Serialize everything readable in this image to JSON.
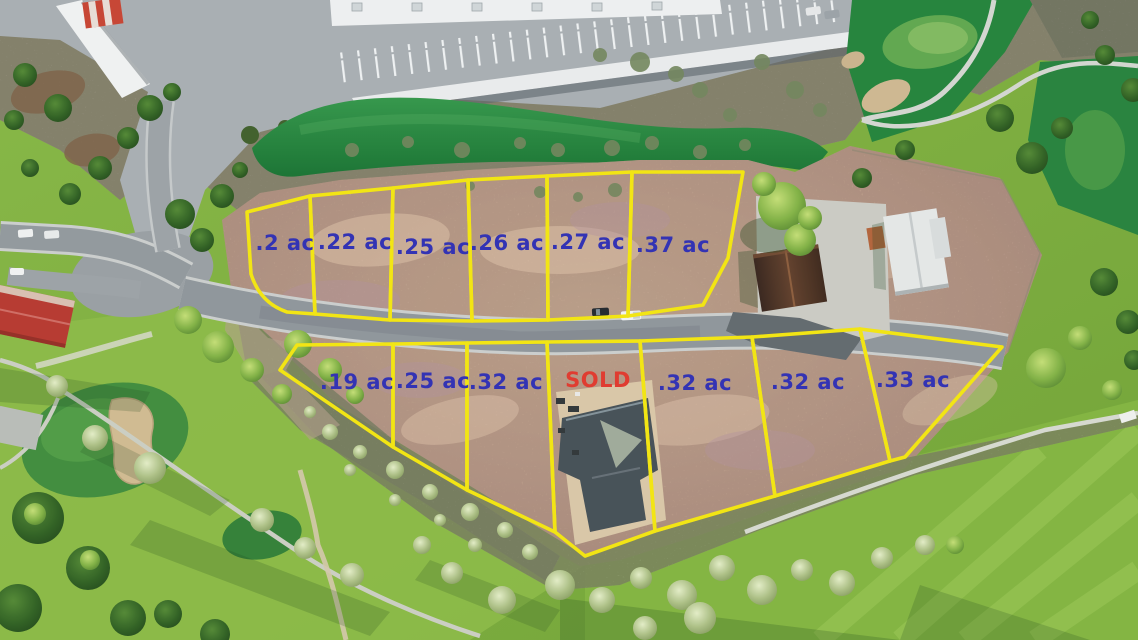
{
  "colors": {
    "lot_line_yellow": "#F2E40C",
    "label_blue": "#2B2BB2",
    "sold_red": "#DF352A"
  },
  "lots": {
    "top_row": [
      {
        "id": "top-1",
        "label": ".2 ac"
      },
      {
        "id": "top-2",
        "label": ".22 ac"
      },
      {
        "id": "top-3",
        "label": ".25 ac"
      },
      {
        "id": "top-4",
        "label": ".26 ac"
      },
      {
        "id": "top-5",
        "label": ".27 ac"
      },
      {
        "id": "top-6",
        "label": ".37 ac"
      }
    ],
    "bottom_row": [
      {
        "id": "bottom-1",
        "label": ".19 ac"
      },
      {
        "id": "bottom-2",
        "label": ".25 ac"
      },
      {
        "id": "bottom-3",
        "label": ".32 ac"
      },
      {
        "id": "bottom-4",
        "label": "SOLD",
        "status": "sold"
      },
      {
        "id": "bottom-5",
        "label": ".32 ac"
      },
      {
        "id": "bottom-6",
        "label": ".32 ac"
      },
      {
        "id": "bottom-7",
        "label": ".33 ac"
      }
    ]
  }
}
